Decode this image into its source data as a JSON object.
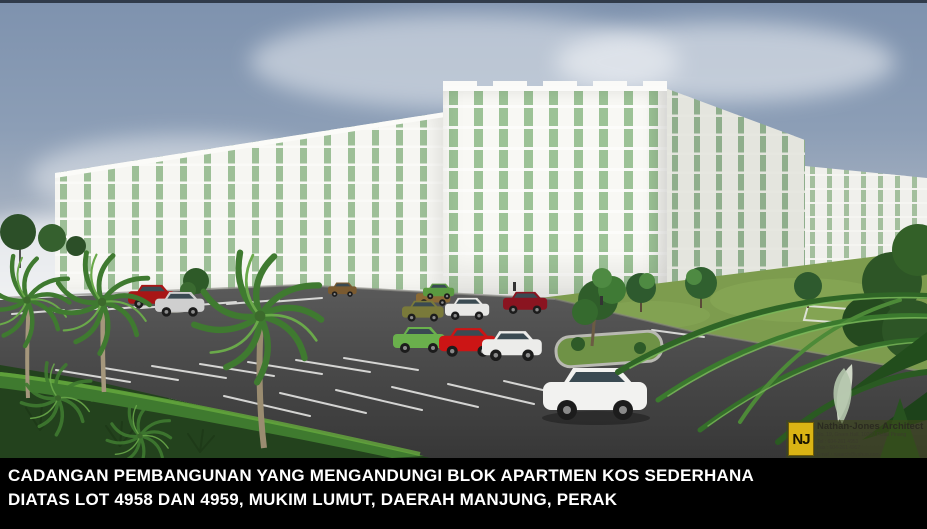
{
  "caption": {
    "line1": "CADANGAN PEMBANGUNAN YANG MENGANDUNGI BLOK APARTMEN KOS SEDERHANA",
    "line2": "DIATAS LOT 4958 DAN 4959, MUKIM LUMUT, DAERAH MANJUNG, PERAK"
  },
  "architect_stamp": {
    "logo_initials": "NJ",
    "firm": "Nathan-Jones Architect",
    "address": "No. 19, Green Hall, 10200 Pulau Pinang",
    "tel": "Tel : 604-261 4953",
    "fax": "Fax : 604-261 4957",
    "email": "Email : njaarch@yahoo.com"
  },
  "scene": {
    "description": "3D architectural rendering of a proposed medium-cost apartment development: rows of white multi-storey apartment blocks with green windows, a large asphalt parking lot with white stall markings, assorted cars, palm trees and landscaped greenery under a cloudy blue sky.",
    "palette": {
      "sky": "#8c9eb6",
      "building_wall": "#f6f6f2",
      "building_window": "#9dbf97",
      "asphalt": "#4e4e4e",
      "lawn": "#7d9c4e",
      "palm_green": "#4d8a38",
      "caption_bg": "#000000",
      "caption_text": "#ffffff",
      "logo_yellow": "#d9b414"
    }
  }
}
